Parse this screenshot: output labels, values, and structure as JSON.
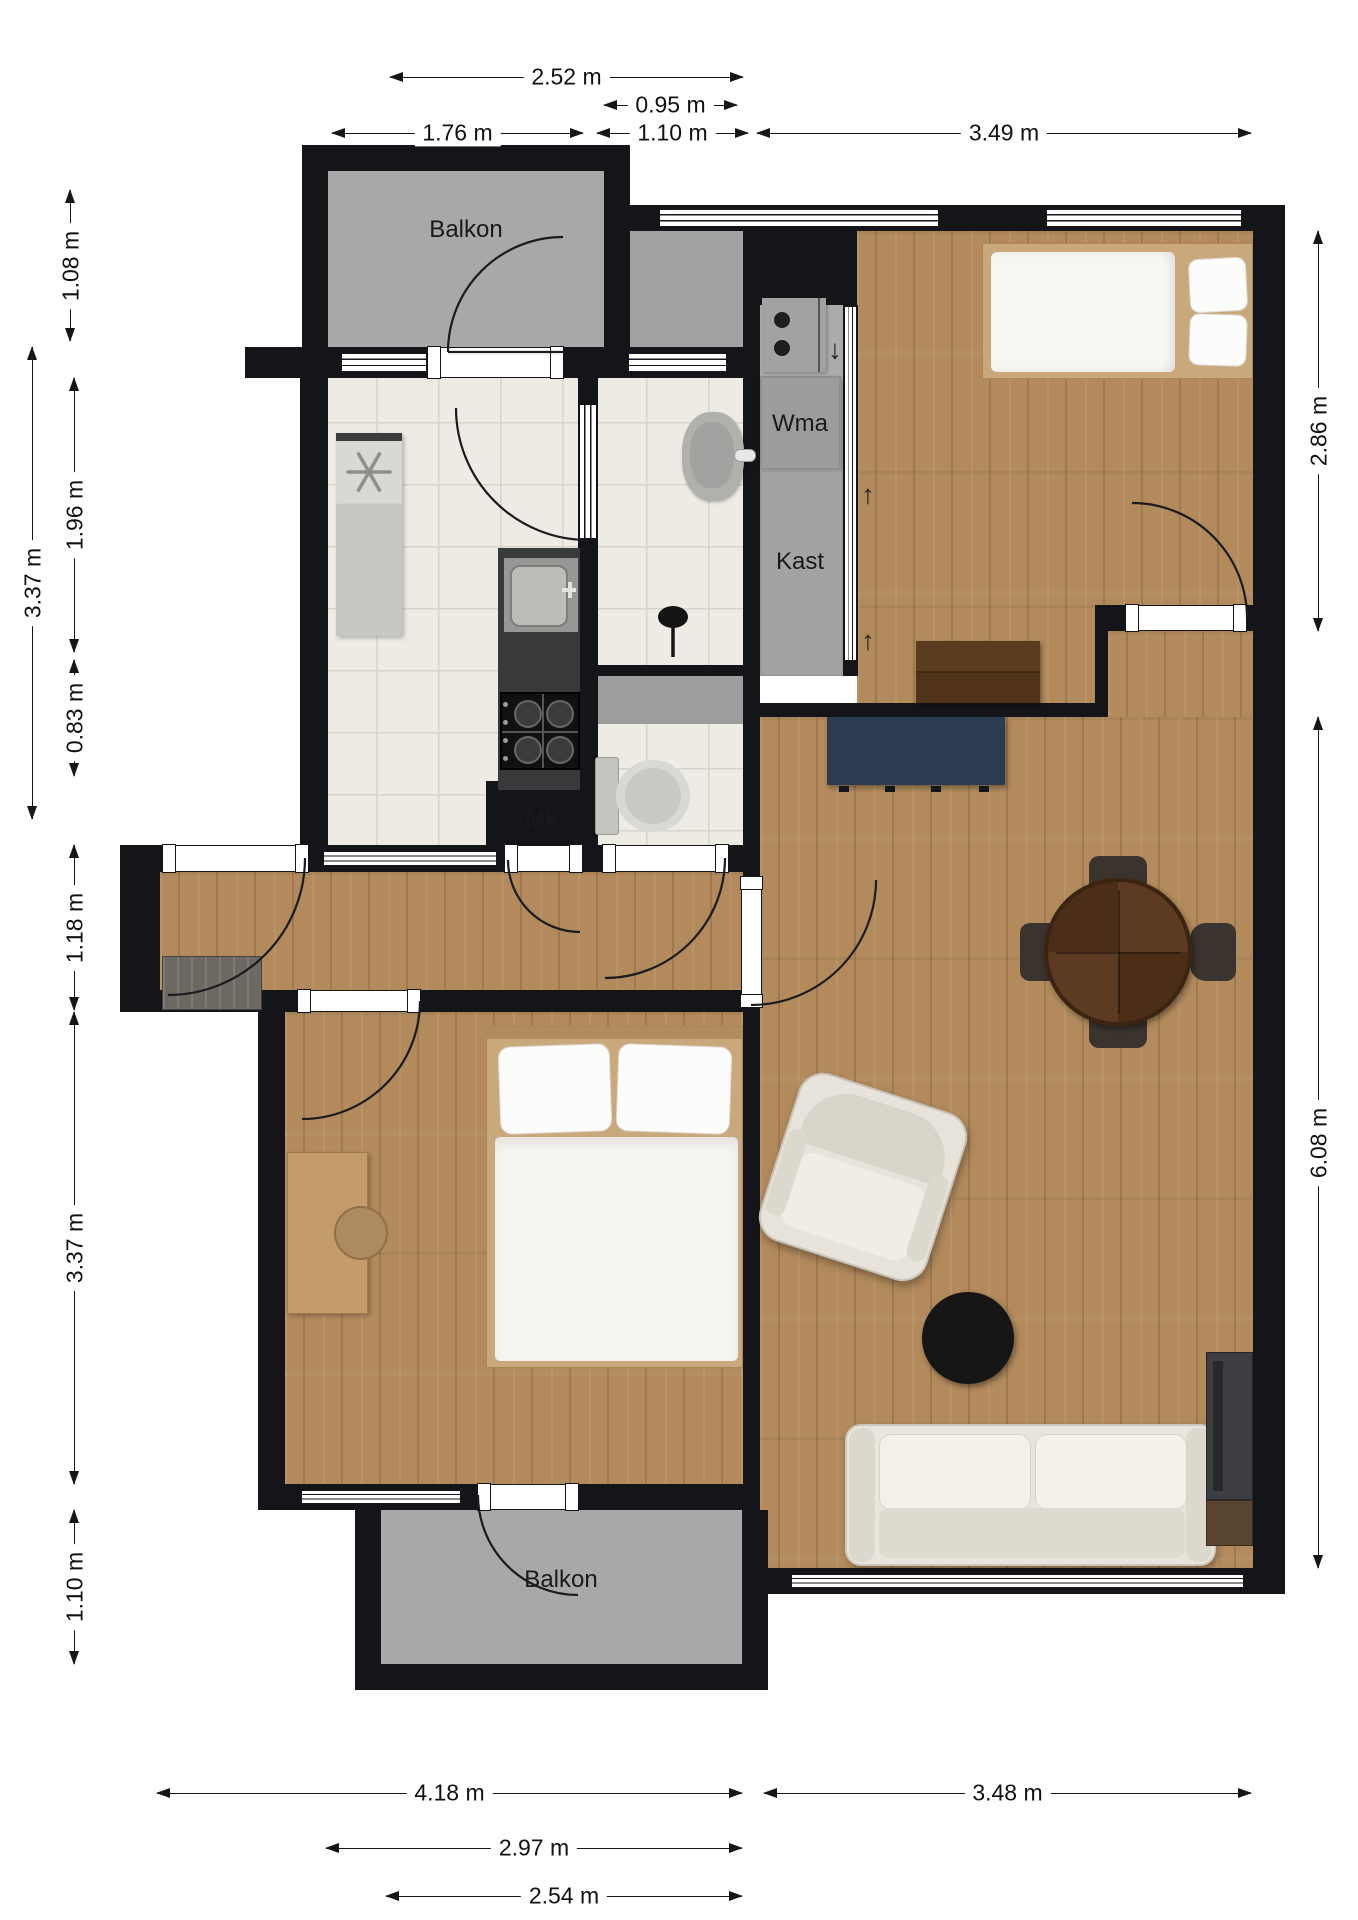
{
  "floor_plan": {
    "room_labels": {
      "balcony_top": "Balkon",
      "washing_machine": "Wma",
      "closet": "Kast",
      "meter_cupboard": "Mk",
      "balcony_bottom": "Balkon"
    },
    "flow_arrows": {
      "down": "↓",
      "up1": "↑",
      "up2": "↑"
    },
    "dimensions": {
      "top": [
        "2.52 m",
        "0.95 m",
        "1.76 m",
        "1.10 m",
        "3.49 m"
      ],
      "left": [
        "1.08 m",
        "3.37 m",
        "1.96 m",
        "0.83 m",
        "1.18 m",
        "3.37 m",
        "1.10 m"
      ],
      "right": [
        "2.86 m",
        "6.08 m"
      ],
      "bottom": [
        "4.18 m",
        "3.48 m",
        "2.97 m",
        "2.54 m"
      ]
    },
    "colors": {
      "wall": "#141519",
      "wood_floor": "#b28a5c",
      "tile_floor": "#edebe3",
      "balcony_floor": "#a8a8a8",
      "utility_floor": "#ababab",
      "sideboard_navy": "#2b3c50",
      "chest_brown": "#50331a",
      "dining_table_brown": "#56361f"
    }
  }
}
